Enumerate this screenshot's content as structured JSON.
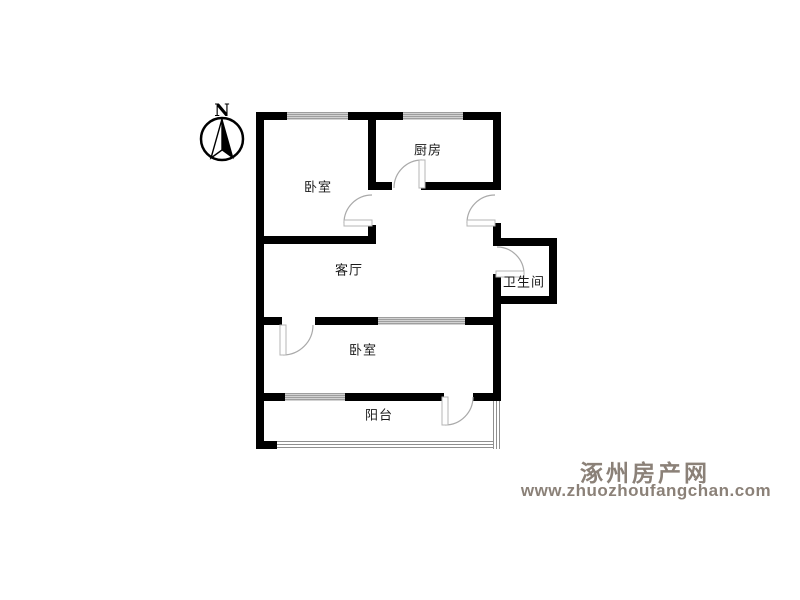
{
  "compass": {
    "label": "N"
  },
  "rooms": {
    "bedroom_top": {
      "label": "卧室"
    },
    "kitchen": {
      "label": "厨房"
    },
    "living_room": {
      "label": "客厅"
    },
    "bathroom": {
      "label": "卫生间"
    },
    "bedroom_bottom": {
      "label": "卧室"
    },
    "balcony": {
      "label": "阳台"
    }
  },
  "watermark": {
    "site_name": "涿州房产网",
    "site_url": "www.zhuozhoufangchan.com"
  },
  "colors": {
    "wall": "#000000",
    "door_arc": "#a9a9a9",
    "door_leaf_border": "#b5b5b5",
    "window_stripe": "#9e9e9e",
    "label_text": "#1a1a1a",
    "watermark_gray": "#8b8178"
  }
}
